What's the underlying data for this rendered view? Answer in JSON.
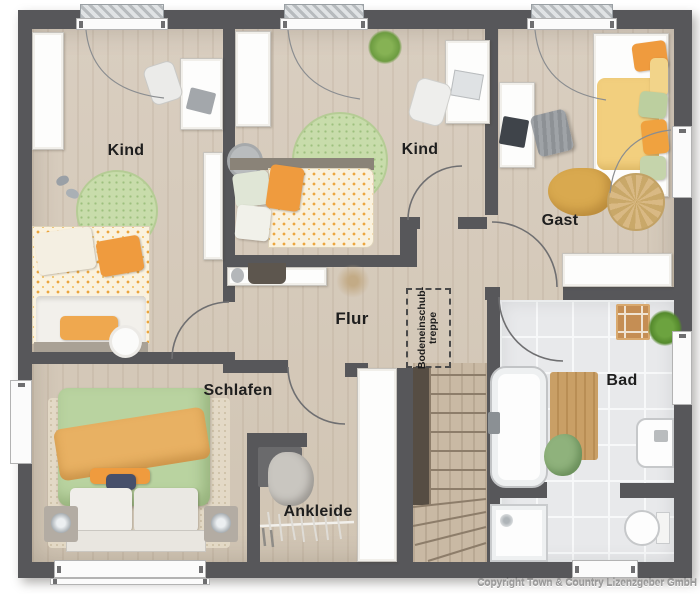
{
  "rooms": {
    "kind1": {
      "label": "Kind"
    },
    "kind2": {
      "label": "Kind"
    },
    "gast": {
      "label": "Gast"
    },
    "flur": {
      "label": "Flur"
    },
    "schlafen": {
      "label": "Schlafen"
    },
    "ankleide": {
      "label": "Ankleide"
    },
    "bad": {
      "label": "Bad"
    }
  },
  "attic_stairs": {
    "line1": "Bodeneinschub-",
    "line2": "treppe"
  },
  "footer": {
    "copyright": "Copyright Town & Country Lizenzgeber GmbH"
  },
  "colors": {
    "wall": "#57575a",
    "wood_floor": "#d5cabb",
    "bath_tile": "#e8e9eb",
    "accent_orange": "#ef9b3e",
    "accent_green": "#b9d3a0",
    "accent_yellow": "#f2cf7e"
  }
}
